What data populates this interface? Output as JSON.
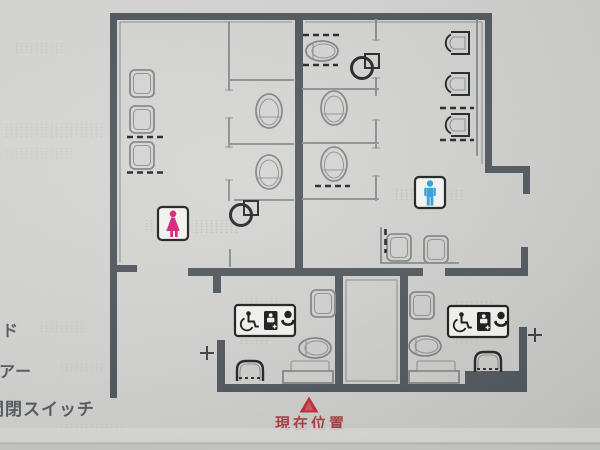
{
  "sign": {
    "kind": "tactile-restroom-floor-plan",
    "marker": {
      "label": "現在位置"
    },
    "left_labels": [
      {
        "text": "ド"
      },
      {
        "text": "アー"
      },
      {
        "text": "開閉スイッチ"
      }
    ],
    "icons": [
      "female-icon",
      "male-icon",
      "wheelchair-icon",
      "baby-changing-station-icon",
      "baby-care-icon",
      "toilet-icon",
      "urinal-icon",
      "washbasin-icon",
      "corner-basin-icon",
      "door-switch-cross-icon",
      "current-position-triangle-icon"
    ],
    "colors": {
      "female_pink": "#d81a78",
      "male_blue": "#2b9fd6",
      "marker_red": "#bf2a33",
      "marker_red_light": "#da5560",
      "marker_text_red": "#a73b40",
      "wall_gray": "#4d545b",
      "label_gray": "#565b60",
      "sign_background": "#d2d3d0"
    }
  }
}
